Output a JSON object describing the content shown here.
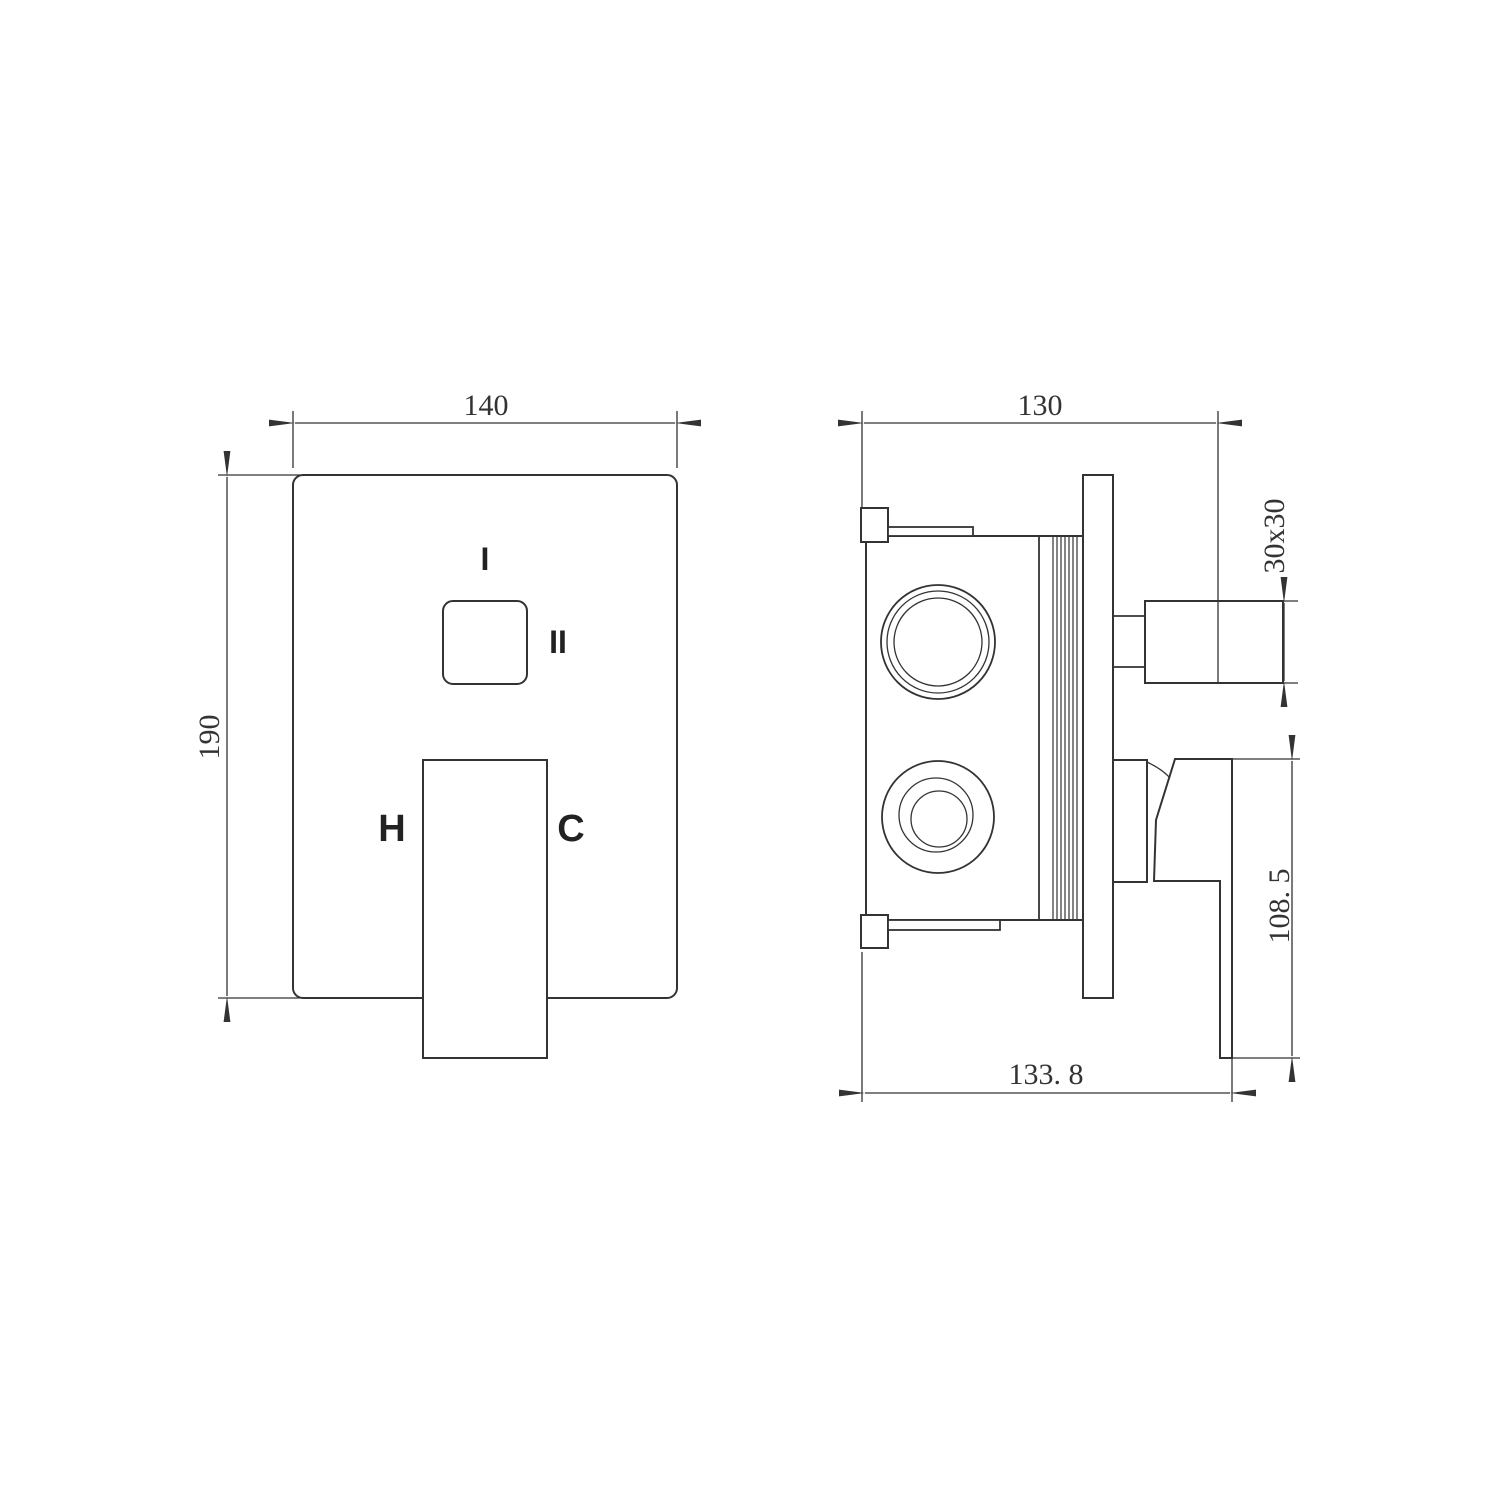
{
  "colors": {
    "line": "#333333",
    "background": "#ffffff"
  },
  "front_view": {
    "dim_width": "140",
    "dim_height": "190",
    "label_diverter_position_1": "I",
    "label_diverter_position_2": "II",
    "label_hot": "H",
    "label_cold": "C"
  },
  "side_view": {
    "dim_depth": "130",
    "dim_outlet_square": "30x30",
    "dim_handle_height": "108. 5",
    "dim_total_depth": "133. 8"
  }
}
